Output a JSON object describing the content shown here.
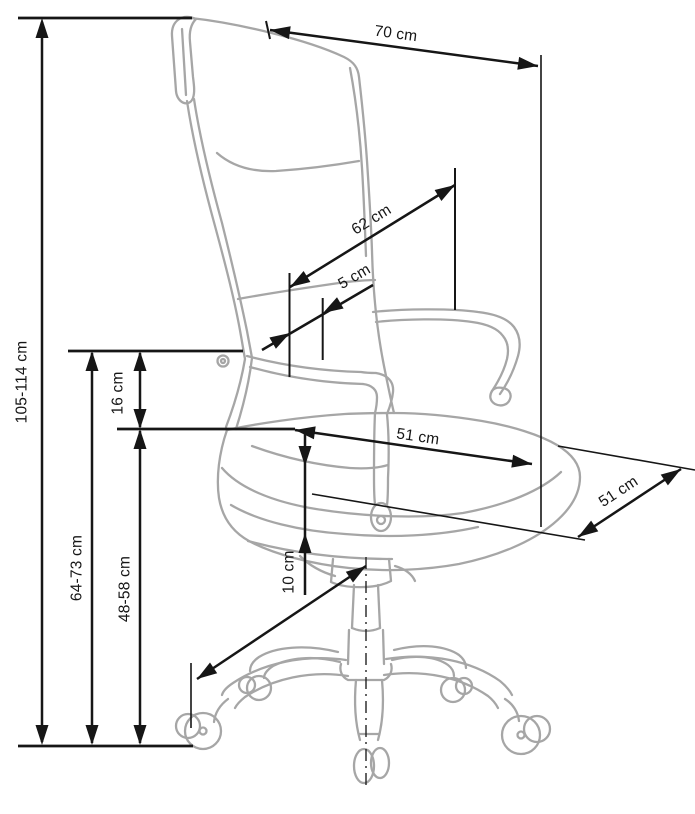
{
  "diagram": {
    "unit": "cm",
    "colors": {
      "dimension_line": "#161616",
      "chair_line": "#a6a6a6",
      "background": "#ffffff"
    },
    "dimensions": [
      {
        "id": "total-height",
        "label": "105-114 cm"
      },
      {
        "id": "backrest-width",
        "label": "70 cm"
      },
      {
        "id": "backrest-height",
        "label": "62 cm"
      },
      {
        "id": "backrest-gap",
        "label": "5 cm"
      },
      {
        "id": "floor-to-armrest",
        "label": "64-73 cm"
      },
      {
        "id": "armrest-above-seat",
        "label": "16 cm"
      },
      {
        "id": "seat-height",
        "label": "48-58 cm"
      },
      {
        "id": "seat-depth",
        "label": "51 cm"
      },
      {
        "id": "seat-width",
        "label": "51 cm"
      },
      {
        "id": "height-adjustment",
        "label": "10 cm"
      }
    ]
  }
}
